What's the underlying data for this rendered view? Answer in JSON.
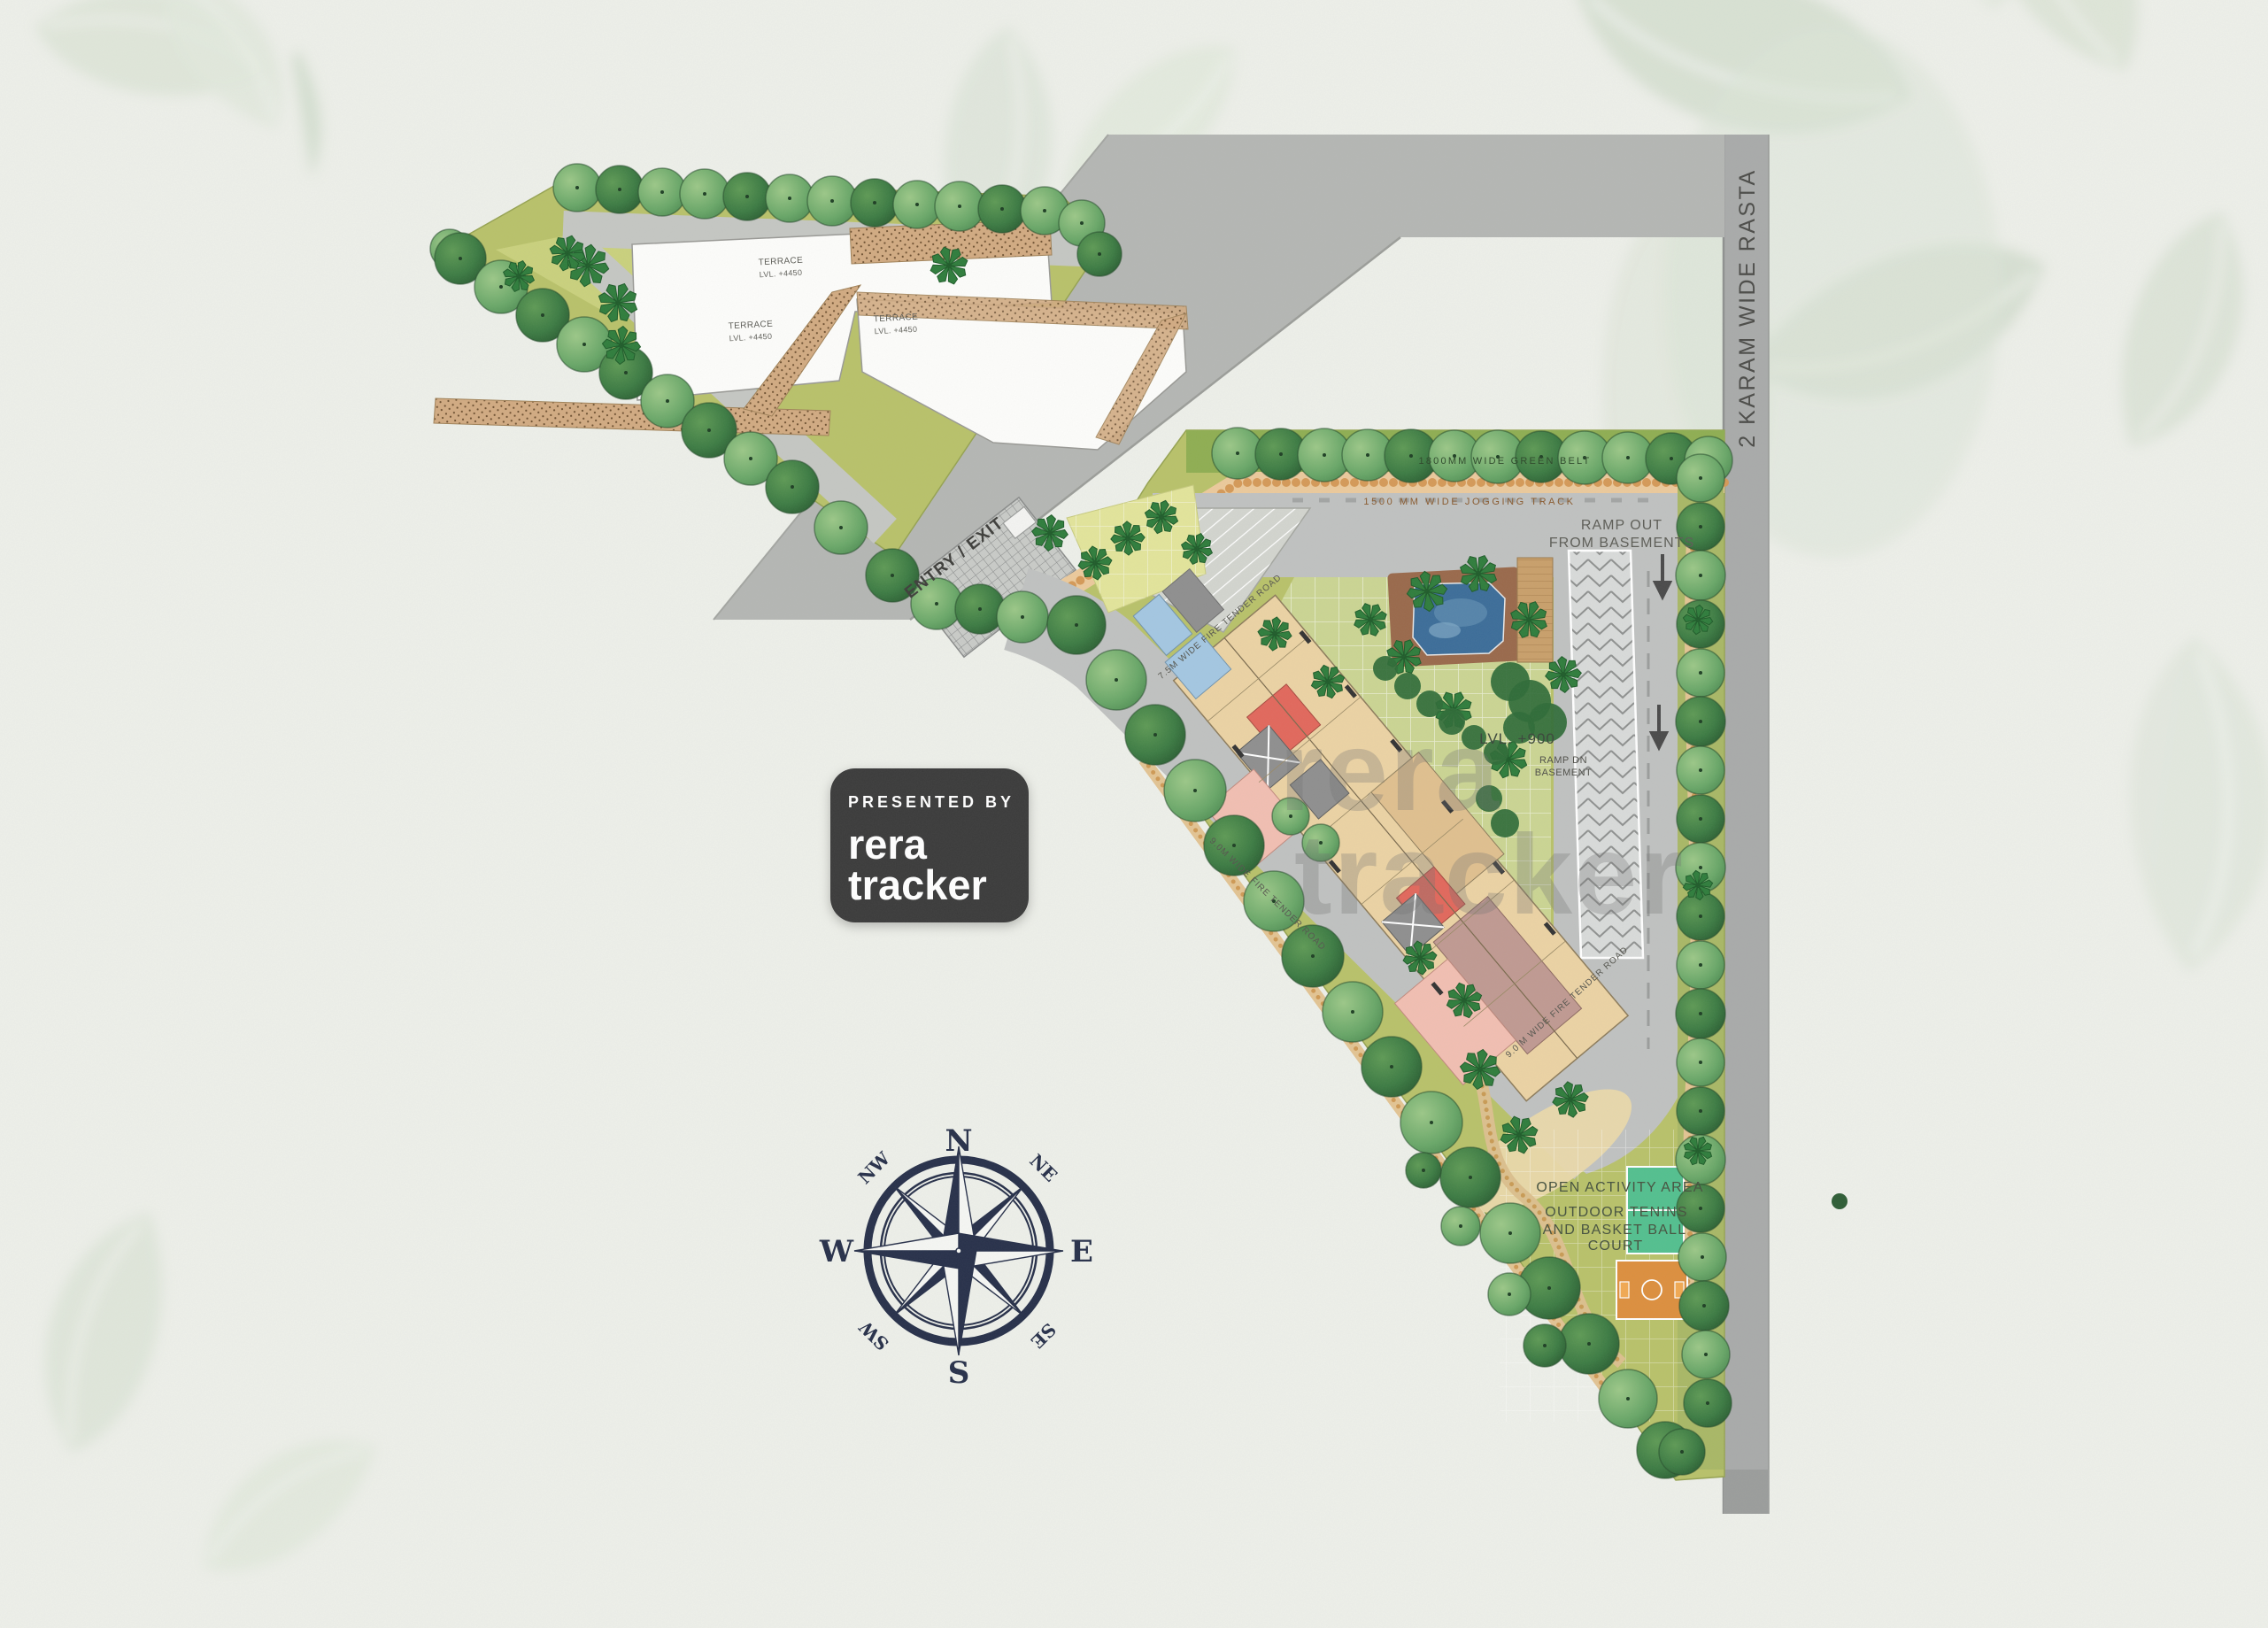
{
  "palette": {
    "paper": "#eef0ea",
    "leaf_wash": "#dde5d8",
    "road_gray": "#bfc1c0",
    "band_gray": "#b5b7b4",
    "rasta_gray": "#a9abaa",
    "lawn_olive": "#b9c26a",
    "lawn_tile": "#cbd593",
    "green_belt": "#8fae52",
    "tree_light": "#69a768",
    "tree_dark": "#3c7b43",
    "palm_green": "#2f7d3c",
    "hedge_green": "#2f6b37",
    "building_beige": "#ecd3a4",
    "building_pink": "#f2bfb2",
    "building_red": "#e2685c",
    "building_blue": "#a4c7e2",
    "building_mauve": "#c09a92",
    "core_gray": "#8f8f8f",
    "pool_water": "#3c6d99",
    "pool_deck": "#9a694b",
    "hatch_tan": "#d2ab82",
    "track_tan": "#ecca9c",
    "court_green": "#53c08f",
    "court_orange": "#dd8f3e",
    "compass_navy": "#27304a",
    "badge_bg": "#3a3a3a",
    "badge_text": "#ffffff",
    "label_gray": "#4a4a4a",
    "watermark_gray": "#707070"
  },
  "badge": {
    "presented_by": "PRESENTED BY",
    "brand_top": "rera",
    "brand_bottom": "tracker"
  },
  "watermark": {
    "top": "rera",
    "bottom": "tracker"
  },
  "compass": {
    "n": "N",
    "ne": "NE",
    "e": "E",
    "se": "SE",
    "s": "S",
    "sw": "SW",
    "w": "W",
    "nw": "NW"
  },
  "labels": {
    "rasta": "2 KARAM WIDE RASTA",
    "entry_exit": "ENTRY / EXIT",
    "green_belt": "1800MM WIDE GREEN BELT",
    "jogging_track": "1500 MM WIDE JOGGING TRACK",
    "ramp_out_1": "RAMP OUT",
    "ramp_out_2": "FROM BASEMENTS",
    "ramp_dn_1": "RAMP DN",
    "ramp_dn_2": "BASEMENT",
    "level_podium": "LVL. +900",
    "fire_road_75": "7.5M WIDE FIRE TENDER ROAD",
    "fire_road_90": "9.0M WIDE FIRE TENDER ROAD",
    "fire_road_90_right": "9.0 M WIDE FIRE TENDER ROAD",
    "open_activity": "OPEN ACTIVITY AREA",
    "outdoor_1": "OUTDOOR TENINS",
    "outdoor_2": "AND BASKET BALL",
    "outdoor_3": "COURT",
    "terrace": "TERRACE",
    "terrace_level": "LVL. +4450"
  }
}
